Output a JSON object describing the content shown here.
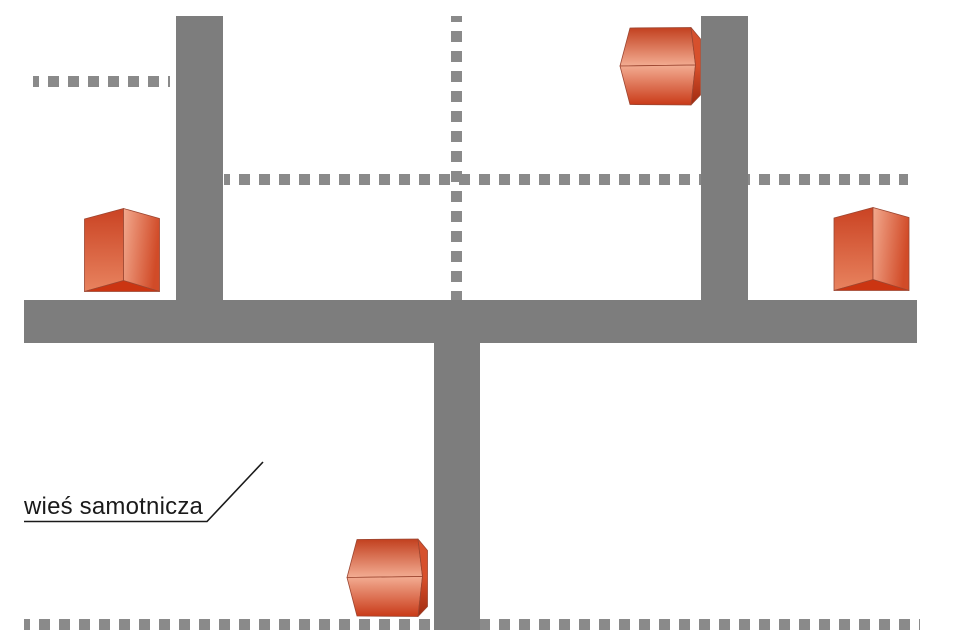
{
  "diagram": {
    "label": "wieś samotnicza"
  },
  "colors": {
    "background": "#ffffff",
    "road": "#7d7d7d",
    "dashed_path": "#8a8a8a",
    "house_red_dark": "#c63517",
    "house_red_mid": "#d5512e",
    "house_red_light": "#f3ad93",
    "label_text": "#1a1a1a"
  },
  "elements": {
    "roads": [
      {
        "name": "road-vertical-left",
        "orientation": "vertical"
      },
      {
        "name": "road-vertical-right",
        "orientation": "vertical"
      },
      {
        "name": "road-horizontal-main",
        "orientation": "horizontal"
      },
      {
        "name": "road-vertical-bottom",
        "orientation": "vertical"
      }
    ],
    "dashed_paths": [
      {
        "name": "dashed-path-top-left",
        "orientation": "horizontal"
      },
      {
        "name": "dashed-path-middle",
        "orientation": "horizontal"
      },
      {
        "name": "dashed-path-vertical-center",
        "orientation": "vertical"
      },
      {
        "name": "dashed-path-bottom",
        "orientation": "horizontal"
      }
    ],
    "houses": [
      {
        "name": "house-top",
        "orientation": "gable-left"
      },
      {
        "name": "house-left",
        "orientation": "gable-up"
      },
      {
        "name": "house-right",
        "orientation": "gable-up"
      },
      {
        "name": "house-bottom",
        "orientation": "gable-left"
      }
    ]
  }
}
